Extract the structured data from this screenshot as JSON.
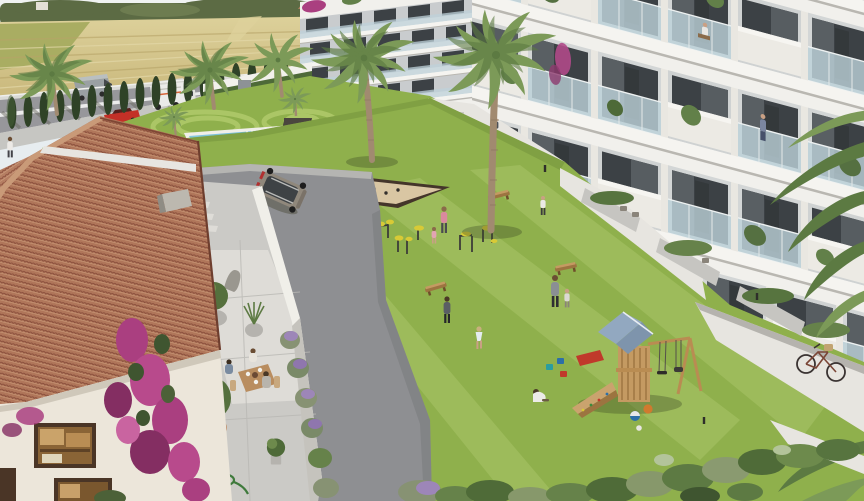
{
  "scene": {
    "type": "architectural-render",
    "setting": "aerial view of a Mediterranean residential complex with communal garden",
    "palette": {
      "sky": "#e7edf0",
      "haze": "#f2f4f2",
      "horizonTree": "#5c6b44",
      "field": "#cdbb7d",
      "fieldLight": "#ddd19b",
      "fieldGreen": "#a9ad62",
      "road": "#97979b",
      "roadLine": "#ececec",
      "sidewalk": "#c6c6c2",
      "cypress": "#2f4227",
      "cypressLight": "#47603a",
      "wallWhite": "#f2f1ec",
      "hedge": "#4e6a38",
      "building": "#f1f0ec",
      "slabShadow": "#b9b7b1",
      "glass": "#bdd2da",
      "window": "#3c4145",
      "interior": "#d3d6d6",
      "balconyWhite": "#eceae4",
      "lawn": "#8fb04c",
      "lawnLight": "#a8c464",
      "lawnDark": "#76963e",
      "pool": "#4fa5c9",
      "poolLight": "#93d2e4",
      "sand": "#d9c6a3",
      "sandBorder": "#44352a",
      "asphalt": "#8e8f92",
      "pathLight": "#e7e5e0",
      "terrace": "#cbcac6",
      "terraceLight": "#dedcd7",
      "roof": "#b0765a",
      "roofDark": "#8e5340",
      "roofLight": "#c99a78",
      "houseWall": "#ece6da",
      "boug": "#aa3f80",
      "bougDark": "#842e62",
      "lavender": "#9d86b8",
      "lavFoliage": "#879273",
      "palmFrond": "#7c9a58",
      "palmDark": "#5c7a42",
      "trunk": "#a18a70",
      "wood": "#c49a62",
      "woodDark": "#9c7440",
      "playRoof": "#92a8c0",
      "gymYellow": "#d8ca36",
      "skin": "#c9a084",
      "suvBody": "#90887c",
      "redCar": "#c33027",
      "truckWhite": "#ebebe9",
      "vanGrey": "#9aa0a3",
      "bike": "#3a3332"
    },
    "elements": [
      "wheat-fields-with-tree-line",
      "perimeter-road-with-van-box-truck-red-car",
      "cypress-hedge-row",
      "five-palm-trees",
      "background-apartment-block",
      "swimming-pool-with-swimmers",
      "mown-circle-lawn",
      "raised-planters",
      "right-apartment-building-five-floors-glass-balconies",
      "balcony-residents",
      "ground-floor-terraces-planters",
      "white-walkway-with-bicycle",
      "central-lawn",
      "petanque-sand-court",
      "outdoor-gym-equipment",
      "wooden-benches",
      "playground-tower-blue-roof-climbing-ramp-swing",
      "toys-buckets-balls",
      "red-slide",
      "residents-walking-jogging-children-playing",
      "clubhouse-terracotta-roof",
      "white-walls-windows",
      "bougainvillea",
      "stone-terrace-dining-table-three-people",
      "potted-olive-trees",
      "lavender-bed",
      "garden-hose",
      "grey-suv-on-driveway",
      "curved-asphalt-driveway",
      "shrub-border"
    ],
    "counts": {
      "right_building_visible_floors": 5,
      "background_building_visible_floors": 4,
      "pool_swimmers": 3,
      "terrace_diners": 3
    }
  }
}
